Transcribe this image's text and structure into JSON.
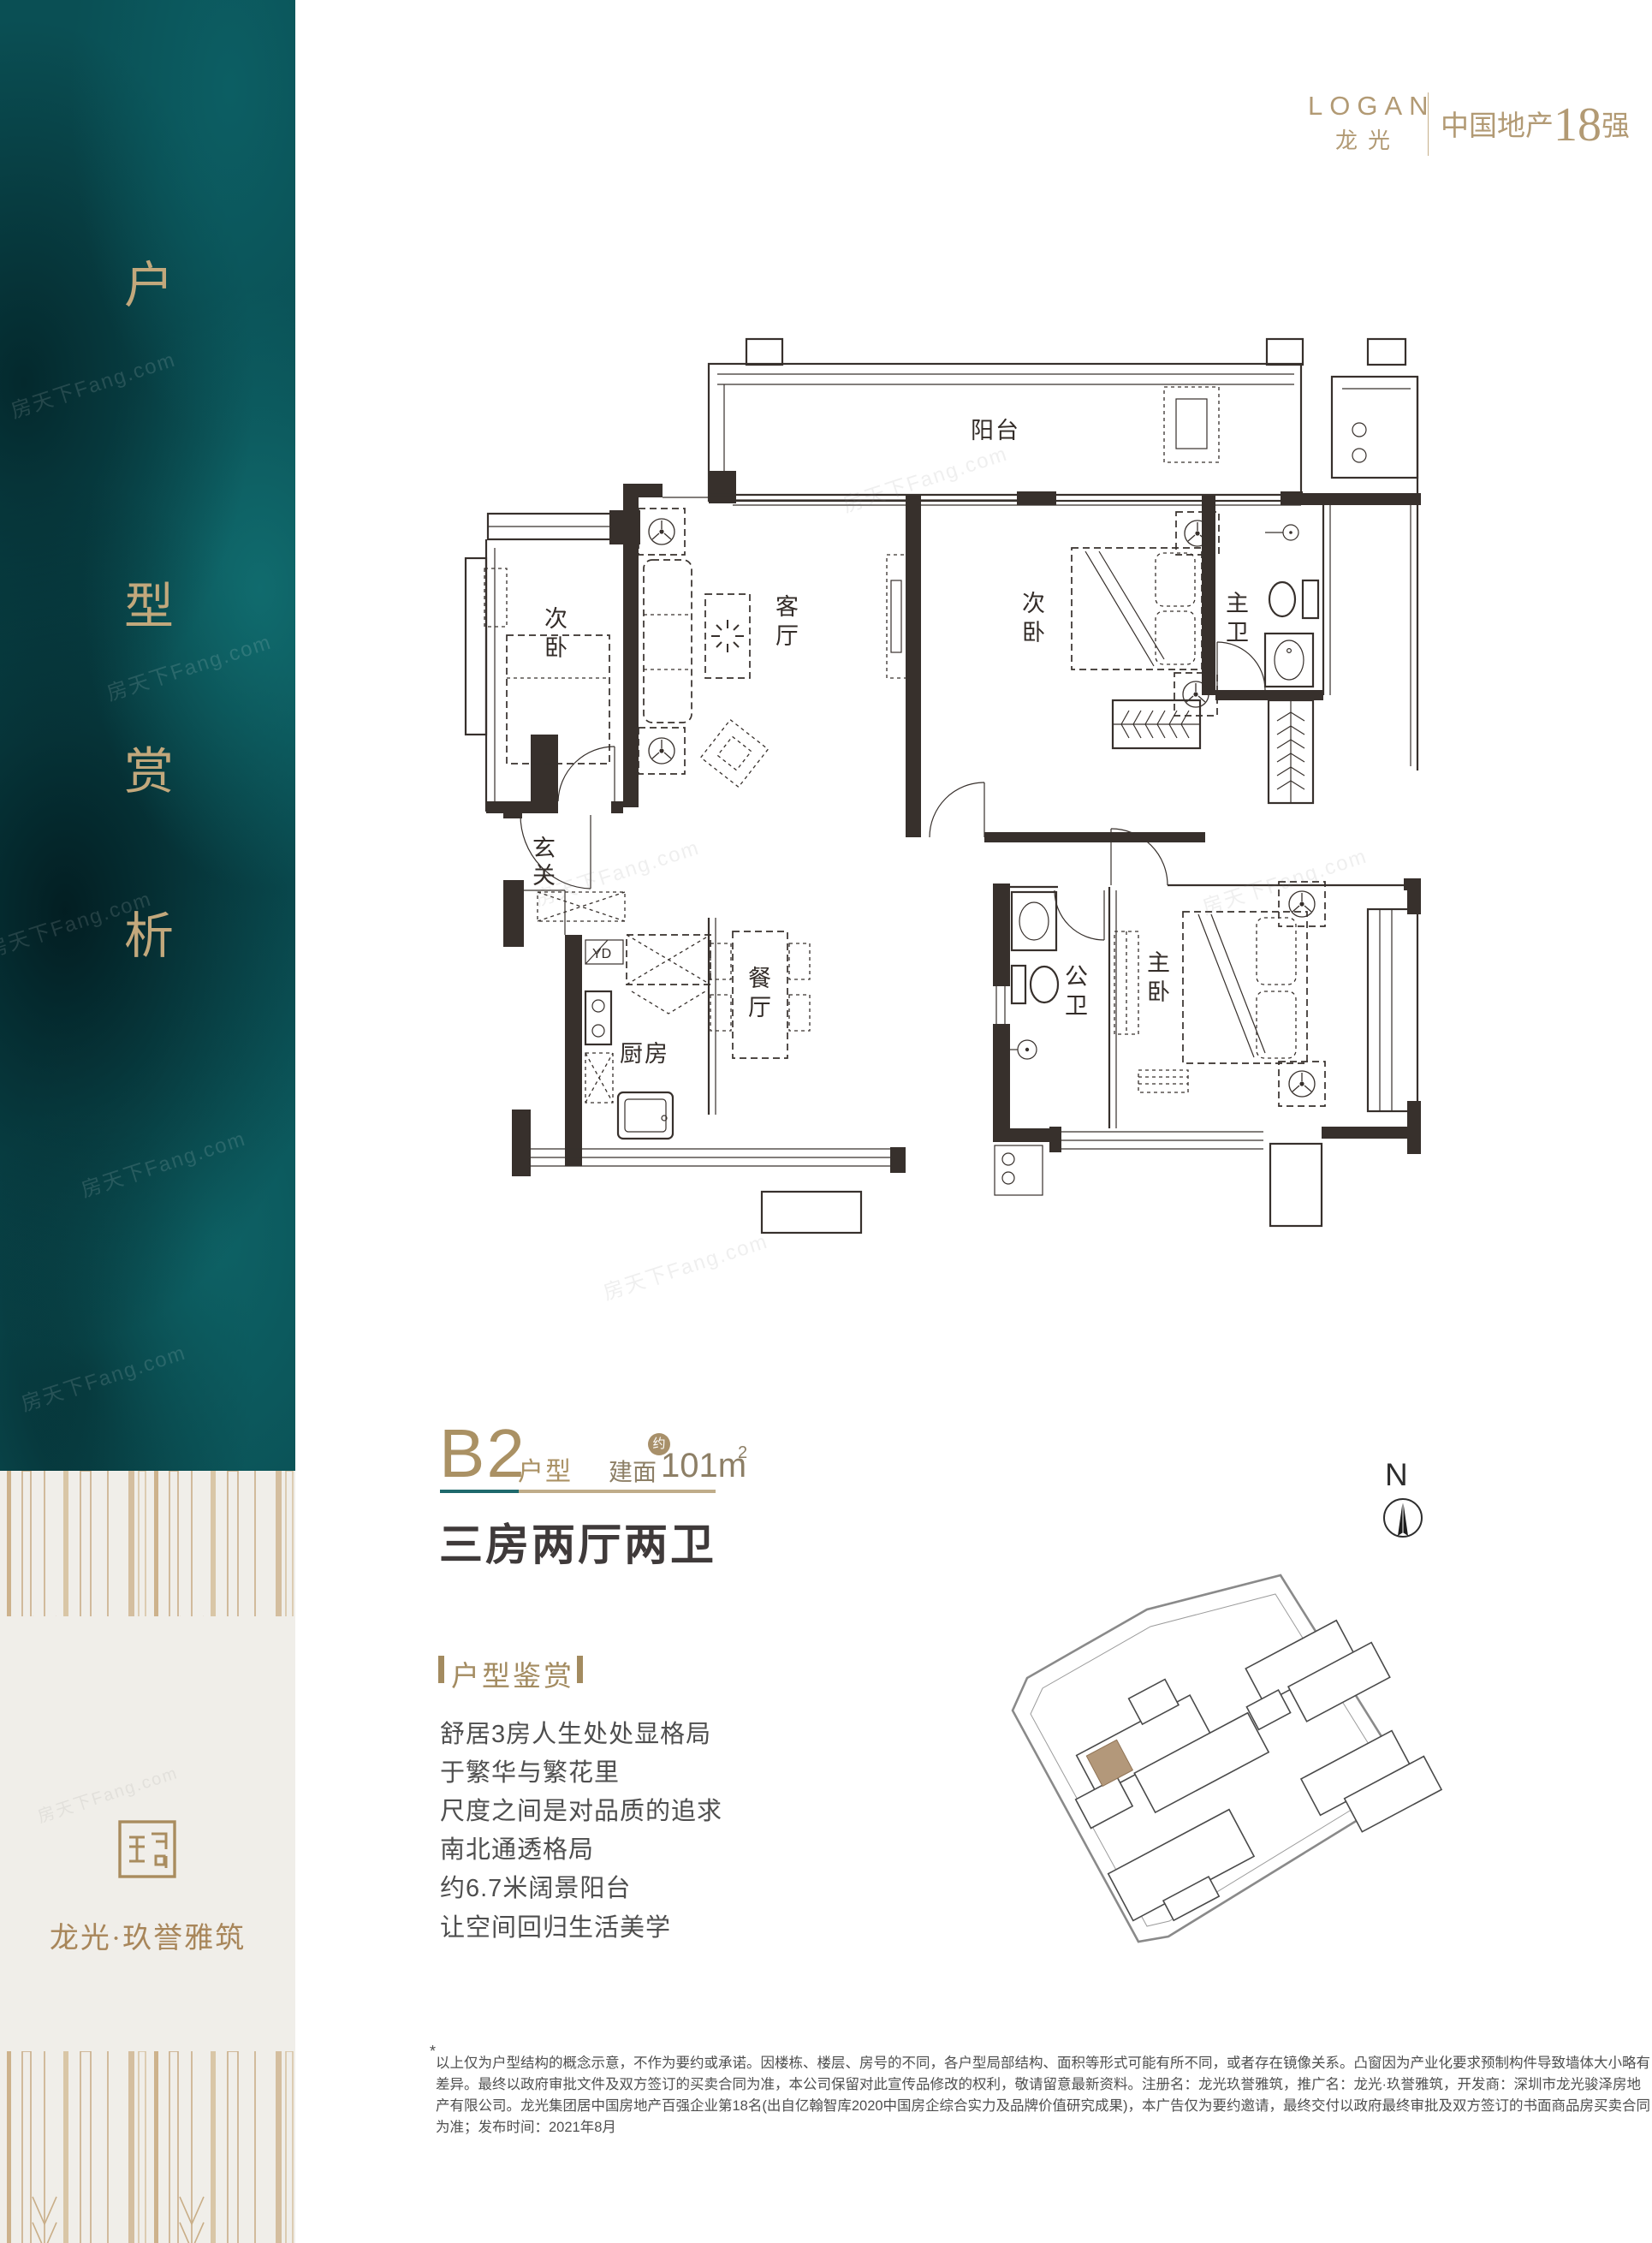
{
  "brand_header": {
    "name_en": "LOGAN",
    "name_cn": "龙光",
    "rank_prefix": "中国地产",
    "rank_number": "18",
    "rank_suffix": "强"
  },
  "sidebar": {
    "vertical_title": [
      "户",
      "型",
      "赏",
      "析"
    ],
    "brand_name": "龙光·玖誉雅筑",
    "watermark": "房天下Fang.com"
  },
  "floorplan": {
    "labels": {
      "balcony": "阳台",
      "bedroom_left": [
        "次",
        "卧"
      ],
      "living": [
        "客",
        "厅"
      ],
      "bedroom_right": [
        "次",
        "卧"
      ],
      "master_bath": [
        "主",
        "卫"
      ],
      "foyer": [
        "玄",
        "关"
      ],
      "yd": "YD",
      "kitchen": "厨房",
      "dining": [
        "餐",
        "厅"
      ],
      "guest_bath": [
        "公",
        "卫"
      ],
      "master_bedroom": [
        "主",
        "卧"
      ]
    }
  },
  "unit_info": {
    "code": "B2",
    "code_label": "户型",
    "area_label": "建面",
    "area_approx": "约",
    "area_value": "101m",
    "area_exp": "2",
    "rooms_summary": "三房两厅两卫"
  },
  "highlights": {
    "title": "户型鉴赏",
    "items": [
      "舒居3房人生处处显格局",
      "于繁华与繁花里",
      "尺度之间是对品质的追求",
      "南北通透格局",
      "约6.7米阔景阳台",
      "让空间回归生活美学"
    ]
  },
  "compass": {
    "north": "N"
  },
  "disclaimer": {
    "star": "*",
    "lines": [
      "以上仅为户型结构的概念示意，不作为要约或承诺。因楼栋、楼层、房号的不同，各户型局部结构、面积等形式可能有所不同，或者存在镜像关系。凸窗因为产业化要求预制构件导致墙体大小略有",
      "差异。最终以政府审批文件及双方签订的买卖合同为准，本公司保留对此宣传品修改的权利，敬请留意最新资料。注册名：龙光玖誉雅筑，推广名：龙光·玖誉雅筑，开发商：深圳市龙光骏泽房地",
      "产有限公司。龙光集团居中国房地产百强企业第18名(出自亿翰智库2020中国房企综合实力及品牌价值研究成果)，本广告仅为要约邀请，最终交付以政府最终审批及双方签订的书面商品房买卖合同",
      "为准；发布时间：2021年8月"
    ]
  },
  "colors": {
    "accent_gold": "#aa9164",
    "deep_teal": "#0a4f54",
    "divider_teal": "#1e696c",
    "divider_gold": "#bfac89",
    "plan_ink": "#37302c",
    "site_highlight": "#b3987a"
  }
}
